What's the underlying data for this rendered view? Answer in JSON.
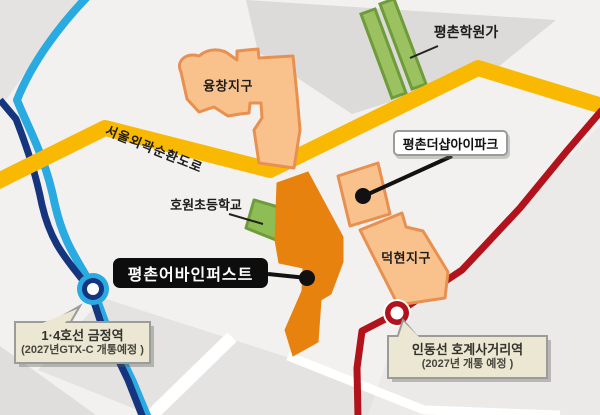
{
  "map": {
    "roads": {
      "expressway_label": "서울외곽순환도로"
    },
    "districts": [
      {
        "name": "융창지구"
      },
      {
        "name": "덕현지구"
      }
    ],
    "places": {
      "academy_street": "평촌학원가",
      "elementary_school": "호원초등학교"
    },
    "apartments": {
      "thesharp_label": "평촌더샵아이파크",
      "urbain_label": "평촌어바인퍼스트"
    },
    "stations": {
      "geumjeong": {
        "line1": "1·4호선 금정역",
        "line2": "(2027년GTX-C 개통예정 )"
      },
      "hogye": {
        "line1": "인동선 호계사거리역",
        "line2": "(2027년 개통 예정 )"
      }
    },
    "colors": {
      "expressway_yellow": "#f9b903",
      "metro_line4_cyan": "#29aae1",
      "metro_line1_navy": "#16357f",
      "indong_line_red": "#b1121b",
      "district_fill": "#f9c28d",
      "district_border": "#e89050",
      "green_fill": "#9bc161",
      "green_border": "#6f9c3a",
      "site_orange": "#e8820e",
      "bubble_bg": "#ece7d3",
      "bubble_border": "#9b9b99"
    }
  }
}
